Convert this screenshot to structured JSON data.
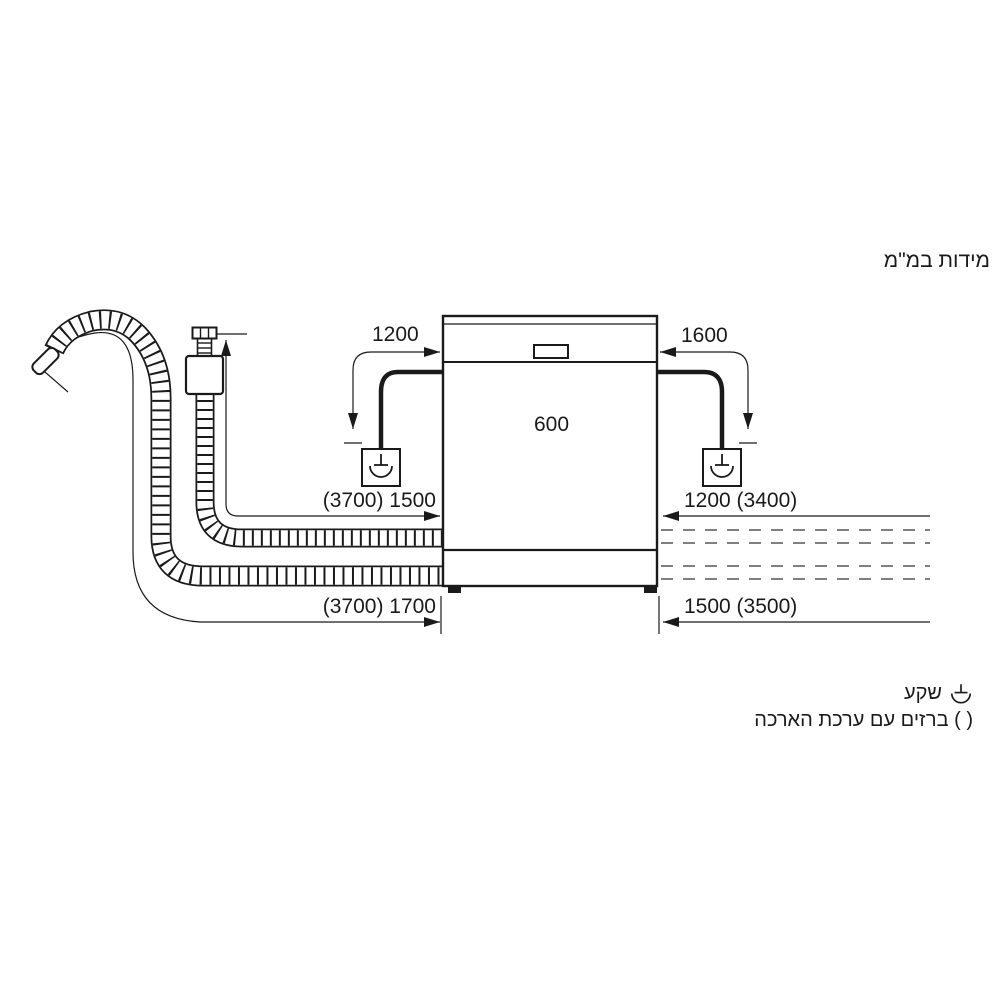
{
  "title": "מידות במ\"מ",
  "colors": {
    "line": "#1a1a1a",
    "background": "#ffffff"
  },
  "dimensions": {
    "power_cord_left": "1200",
    "power_cord_right": "1600",
    "width": "600",
    "inlet_hose_left": "(3700) 1500",
    "inlet_hose_right": "1200 (3400)",
    "drain_hose_left": "(3700) 1700",
    "drain_hose_right": "1500 (3500)"
  },
  "legend": {
    "socket_icon": "socket-icon",
    "socket_label": "שקע",
    "extension_note": "( ) ברזים עם ערכת הארכה"
  }
}
